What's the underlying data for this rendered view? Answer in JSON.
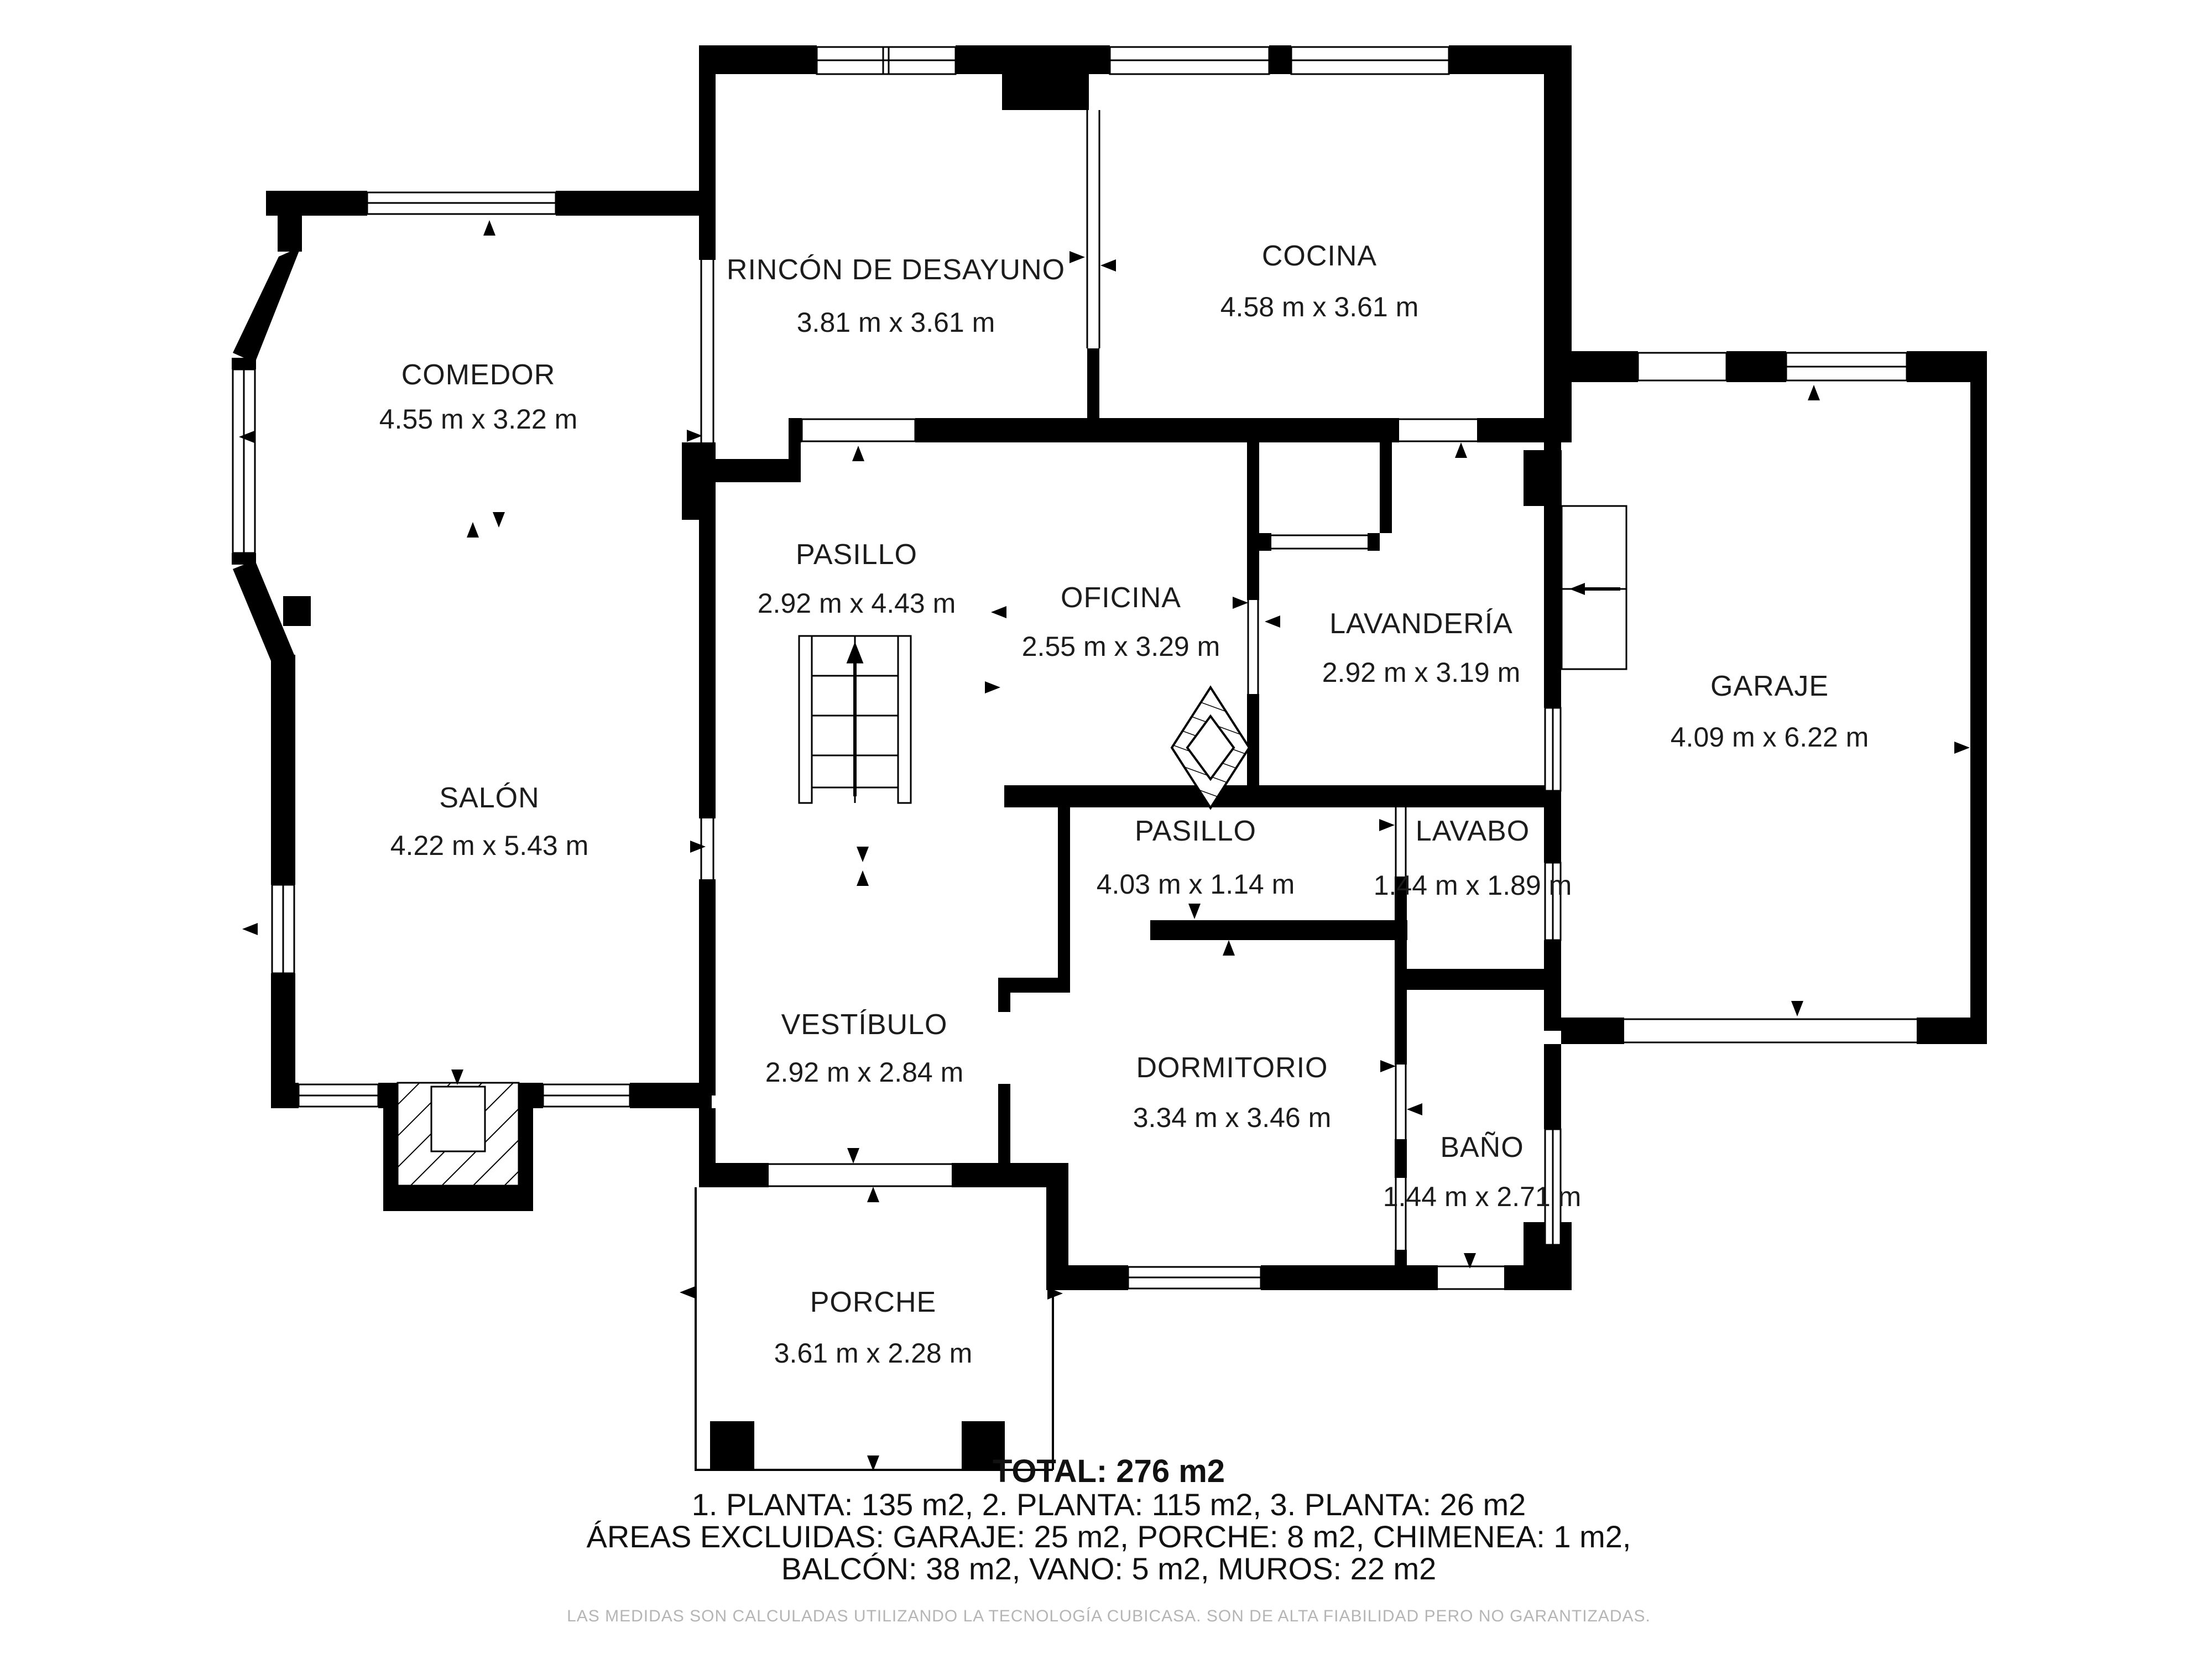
{
  "rooms": {
    "rincon": {
      "name": "RINCÓN DE DESAYUNO",
      "dims": "3.81 m x 3.61 m"
    },
    "cocina": {
      "name": "COCINA",
      "dims": "4.58 m x 3.61 m"
    },
    "comedor": {
      "name": "COMEDOR",
      "dims": "4.55 m x 3.22 m"
    },
    "pasillo": {
      "name": "PASILLO",
      "dims": "2.92 m x 4.43 m"
    },
    "oficina": {
      "name": "OFICINA",
      "dims": "2.55 m x 3.29 m"
    },
    "lavanderia": {
      "name": "LAVANDERÍA",
      "dims": "2.92 m x 3.19 m"
    },
    "garaje": {
      "name": "GARAJE",
      "dims": "4.09 m x 6.22 m"
    },
    "salon": {
      "name": "SALÓN",
      "dims": "4.22 m x 5.43 m"
    },
    "pasillo2": {
      "name": "PASILLO",
      "dims": "4.03 m x 1.14 m"
    },
    "lavabo": {
      "name": "LAVABO",
      "dims": "1.44 m x 1.89 m"
    },
    "vestibulo": {
      "name": "VESTÍBULO",
      "dims": "2.92 m x 2.84 m"
    },
    "dormitorio": {
      "name": "DORMITORIO",
      "dims": "3.34 m x 3.46 m"
    },
    "bano": {
      "name": "BAÑO",
      "dims": "1.44 m x 2.71 m"
    },
    "porche": {
      "name": "PORCHE",
      "dims": "3.61 m x 2.28 m"
    }
  },
  "summary": {
    "total": "TOTAL: 276 m2",
    "line1": "1. PLANTA: 135 m2, 2. PLANTA: 115 m2, 3. PLANTA: 26 m2",
    "line2": "ÁREAS EXCLUIDAS: GARAJE: 25 m2, PORCHE: 8 m2, CHIMENEA: 1 m2,",
    "line3": "BALCÓN: 38 m2, VANO: 5 m2, MUROS: 22 m2"
  },
  "disclaimer": "LAS MEDIDAS SON CALCULADAS UTILIZANDO LA TECNOLOGÍA CUBICASA. SON DE ALTA FIABILIDAD PERO NO GARANTIZADAS.",
  "colors": {
    "wall": "#000000",
    "background": "#ffffff",
    "label_text": "#1c1c1c",
    "disclaimer_text": "#b5b5b5"
  }
}
